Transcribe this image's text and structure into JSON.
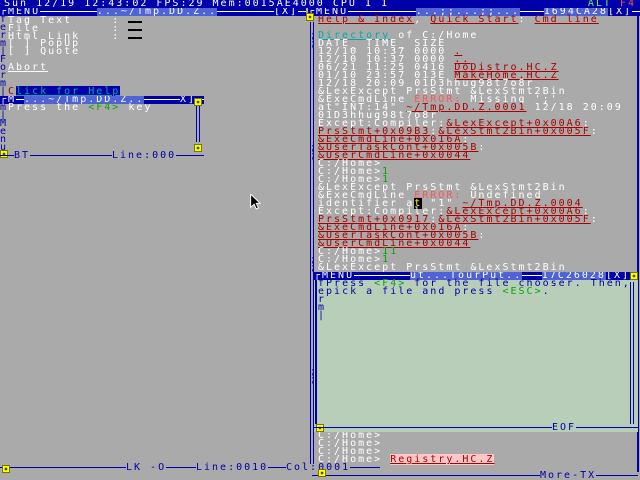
{
  "palette": {
    "blue": "#0000AA",
    "ltblue": "#5555FF",
    "gray": "#AAAAAA",
    "white": "#FFFFFF",
    "red": "#AA0000",
    "ltred": "#FF5555",
    "green": "#00AA00",
    "ltgreen": "#55FF55",
    "cyan": "#00AAAA",
    "yellow": "#FFFF00",
    "black": "#000000",
    "palegreen": "#B8CEB8"
  },
  "topbar": {
    "status": "Sun 12/19 12:43:02 FPS:29 Mem:0015AE4000 CPU 1 1",
    "alt_key": "ALT",
    "f4_key": "F4"
  },
  "left_window": {
    "menu_label": "┌MENU",
    "title": "...~/Tmp.DD.Z..",
    "close_label": "[X]",
    "border_letters": [
      "f",
      "e",
      "r",
      "m",
      "|",
      "F",
      "o",
      "r",
      "m",
      "|"
    ],
    "lines": [
      [
        [
          "w",
          "Tag Text     : "
        ],
        [
          "i",
          ""
        ]
      ],
      [
        [
          "w",
          "File         : "
        ],
        [
          "i",
          ""
        ]
      ],
      [
        [
          "w",
          "Html Link    : "
        ],
        [
          "i",
          ""
        ]
      ],
      [
        [
          "chk",
          "[ ] "
        ],
        [
          "w",
          "PopUp"
        ]
      ],
      [
        [
          "chk",
          "[ ] "
        ],
        [
          "w",
          "Quote"
        ]
      ],
      [],
      [
        [
          "lw",
          "Abort"
        ]
      ],
      [],
      [],
      [
        [
          "R2",
          "C"
        ],
        [
          "hl",
          "lick for Help"
        ]
      ]
    ],
    "bottom": {
      "lock": "LK -O",
      "line": "Line:0010",
      "col": "Col:0001"
    }
  },
  "dialog": {
    "menu_label": "┌M",
    "title": "...~/Tmp.DD.Z..",
    "close_label": "X]",
    "border_letters": [
      "m",
      "|",
      "M",
      "e",
      "n",
      "u"
    ],
    "message": [
      [
        [
          "w",
          "Press the "
        ],
        [
          "g",
          "<F4>"
        ],
        [
          "w",
          " key"
        ]
      ]
    ],
    "okay": {
      "first": "O",
      "rest": "KAY"
    },
    "bottom": {
      "bt": "BT",
      "line": "Line:000"
    }
  },
  "right_window": {
    "menu_label": "┌MENU",
    "title": "...;;...;;...",
    "task_id": "1694CA28",
    "close_label": "[X]",
    "border_semicolon_rows": [
      2,
      3,
      16,
      17,
      30,
      31,
      44,
      45
    ],
    "lines": [
      [
        [
          "r",
          "Help & Index"
        ],
        [
          "w",
          ", "
        ],
        [
          "r",
          "Quick Start"
        ],
        [
          "w",
          ": "
        ],
        [
          "r",
          "Cmd line"
        ]
      ],
      [],
      [
        [
          "c",
          "Directory"
        ],
        [
          "w",
          " of C:/Home"
        ]
      ],
      [
        [
          "w",
          "DATE_ TIME_ SIZE"
        ]
      ],
      [
        [
          "w",
          "12/10 10:37 0000 "
        ],
        [
          "r",
          "."
        ]
      ],
      [
        [
          "w",
          "12/10 10:37 0000 "
        ],
        [
          "r",
          ".."
        ]
      ],
      [
        [
          "w",
          "06/21 11:25 0416 "
        ],
        [
          "r",
          "DoDistro.HC.Z"
        ]
      ],
      [
        [
          "w",
          "01/10 23:57 013E "
        ],
        [
          "r",
          "MakeHome.HC.Z"
        ]
      ],
      [
        [
          "w",
          "12/18 20:09 01D3hhug98t7o8r"
        ]
      ],
      [
        [
          "w",
          "&LexExcept PrsStmt &LexStmt2Bin"
        ]
      ],
      [
        [
          "w",
          "&ExeCmdLine "
        ],
        [
          "R",
          "ERROR: "
        ],
        [
          "w",
          "Missing ';'"
        ]
      ],
      [
        [
          "w",
          "at\"INT:14\" "
        ],
        [
          "r",
          "~/Tmp.DD.Z.0001"
        ],
        [
          "w",
          " 12/18 20:09"
        ]
      ],
      [
        [
          "w",
          "01D3hhug98t7o8r"
        ]
      ],
      [
        [
          "w",
          "Except:Compiler:"
        ],
        [
          "r",
          "&LexExcept+0x00A6"
        ],
        [
          "w",
          ":"
        ]
      ],
      [
        [
          "r",
          "PrsStmt+0x09B3"
        ],
        [
          "w",
          ":"
        ],
        [
          "r",
          "&LexStmt2Bin+0x005F"
        ],
        [
          "w",
          ":"
        ]
      ],
      [
        [
          "r",
          "&ExeCmdLine+0x016A"
        ],
        [
          "w",
          ":"
        ]
      ],
      [
        [
          "r",
          "&UserTaskCont+0x005B"
        ],
        [
          "w",
          ":"
        ]
      ],
      [
        [
          "r",
          "&UserCmdLine+0x0044"
        ]
      ],
      [
        [
          "w",
          "C:/Home>"
        ]
      ],
      [
        [
          "w",
          "C:/Home>"
        ],
        [
          "g",
          "1"
        ]
      ],
      [
        [
          "w",
          "C:/Home>"
        ],
        [
          "g",
          "1"
        ]
      ],
      [
        [
          "w",
          "&LexExcept PrsStmt &LexStmt2Bin"
        ]
      ],
      [
        [
          "w",
          "&ExeCmdLine "
        ],
        [
          "R",
          "ERROR: "
        ],
        [
          "w",
          "Undefined"
        ]
      ],
      [
        [
          "w",
          "identifier a"
        ],
        [
          "k",
          "t"
        ],
        [
          "w",
          " \"1\" "
        ],
        [
          "r",
          "~/Tmp.DD.Z.0004"
        ]
      ],
      [
        [
          "w",
          "Except:Compiler:"
        ],
        [
          "r",
          "&LexExcept+0x00A6"
        ],
        [
          "w",
          ":"
        ]
      ],
      [
        [
          "r",
          "PrsStmt+0x0917"
        ],
        [
          "w",
          ":"
        ],
        [
          "r",
          "&LexStmt2Bin+0x005F"
        ],
        [
          "w",
          ":"
        ]
      ],
      [
        [
          "r",
          "&ExeCmdLine+0x016A"
        ],
        [
          "w",
          ":"
        ]
      ],
      [
        [
          "r",
          "&UserTaskCont+0x005B"
        ],
        [
          "w",
          ":"
        ]
      ],
      [
        [
          "r",
          "&UserCmdLine+0x0044"
        ]
      ],
      [
        [
          "w",
          "C:/Home>"
        ],
        [
          "g",
          "11"
        ]
      ],
      [
        [
          "w",
          "C:/Home>"
        ],
        [
          "g",
          "1"
        ]
      ],
      [
        [
          "w",
          "&LexExcept PrsStmt &LexStmt2Bin"
        ]
      ]
    ],
    "tail_lines": [
      [
        [
          "w",
          "C:/Home>"
        ]
      ],
      [
        [
          "w",
          "C:/Home>"
        ]
      ],
      [
        [
          "w",
          "C:/Home>"
        ]
      ],
      [
        [
          "w",
          "C:/Home> "
        ],
        [
          "p",
          "Registry.HC.Z"
        ]
      ]
    ],
    "bottom_label": "More-TX"
  },
  "green_window": {
    "menu_label": "┌MENU",
    "title": "ut...TourPut..",
    "task_id": "17C26028",
    "close_label": "[X]",
    "lines": [
      [
        [
          "bl",
          "f"
        ],
        [
          "b",
          "Press "
        ],
        [
          "g",
          "<F4>"
        ],
        [
          "b",
          " for the file chooser. Then,"
        ]
      ],
      [
        [
          "bl",
          "e"
        ],
        [
          "b",
          "pick a file and press "
        ],
        [
          "g",
          "<ESC>"
        ],
        [
          "b",
          "."
        ]
      ],
      [
        [
          "bl",
          "r"
        ]
      ],
      [
        [
          "bl",
          "m"
        ]
      ],
      [
        [
          "bl",
          "|"
        ]
      ]
    ],
    "eof_label": "EOF"
  }
}
